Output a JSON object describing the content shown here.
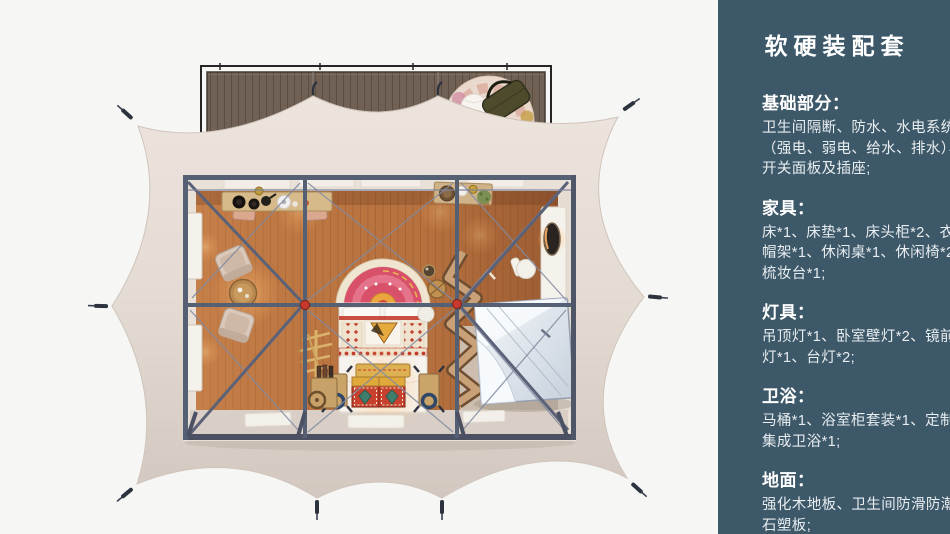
{
  "panel": {
    "title": "软硬装配套",
    "sections": [
      {
        "heading": "基础部分：",
        "lines": [
          "卫生间隔断、防水、水电系统",
          "（强电、弱电、给水、排水）、",
          "开关面板及插座;"
        ]
      },
      {
        "heading": "家具：",
        "lines": [
          "床*1、床垫*1、床头柜*2、衣",
          "帽架*1、休闲桌*1、休闲椅*2、",
          "梳妆台*1;"
        ]
      },
      {
        "heading": "灯具：",
        "lines": [
          "吊顶灯*1、卧室壁灯*2、镜前",
          "灯*1、台灯*2;"
        ]
      },
      {
        "heading": "卫浴：",
        "lines": [
          "马桶*1、浴室柜套装*1、定制",
          "集成卫浴*1;"
        ]
      },
      {
        "heading": "地面：",
        "lines": [
          "强化木地板、卫生间防滑防潮",
          "石塑板;"
        ]
      }
    ]
  },
  "colors": {
    "panel_bg": "#3d5868",
    "panel_heading": "#ffffff",
    "panel_text": "#e8edf0",
    "page_bg": "#f5f5f5",
    "tent_canvas": "#e6ddd5",
    "deck_wood": "#6f6054",
    "floor_wood": "#b4713f",
    "frame_steel": "#566074",
    "joint_red": "#c8392e",
    "lamp_glow": "#ffc489"
  }
}
